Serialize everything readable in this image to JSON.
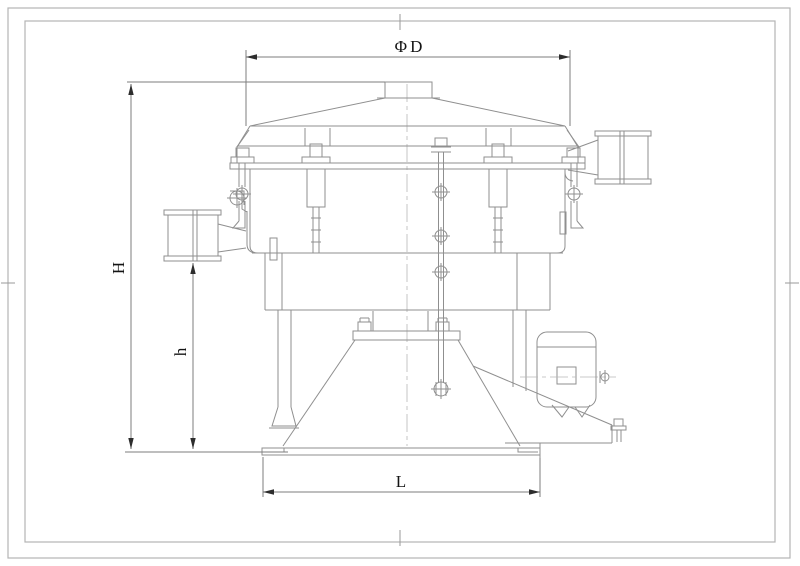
{
  "drawing": {
    "kind": "engineering-dimension-drawing",
    "dimensions": {
      "diameter_label": "ΦD",
      "total_height_label": "H",
      "outlet_height_label": "h",
      "base_length_label": "L"
    },
    "colors": {
      "background": "#ffffff",
      "machine_line": "#8f8f8f",
      "dimension_line": "#7d7d7d",
      "border_line": "#b4b4b4",
      "text": "#141414"
    }
  }
}
